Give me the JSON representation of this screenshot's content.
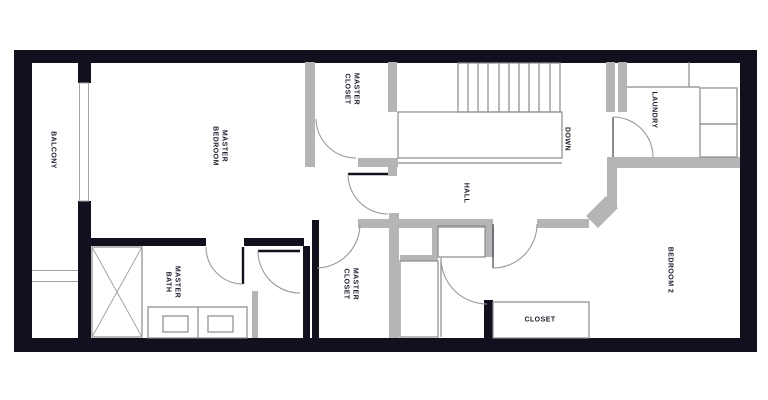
{
  "title": "Second floor plan",
  "colors": {
    "wall_black": "#10101e",
    "wall_gray": "#b5b5b5",
    "thin_line": "#8a8a8a",
    "label_ink": "#1c1c2e",
    "background": "#ffffff"
  },
  "rooms": {
    "balcony": {
      "label": "BALCONY"
    },
    "master_bedroom": {
      "label": "MASTER BEDROOM",
      "line1": "MASTER",
      "line2": "BEDROOM"
    },
    "master_closet_upper": {
      "label": "MASTER CLOSET",
      "line1": "MASTER",
      "line2": "CLOSET"
    },
    "master_bath": {
      "label": "MASTER BATH",
      "line1": "MASTER",
      "line2": "BATH"
    },
    "master_closet_lower": {
      "label": "MASTER CLOSET",
      "line1": "MASTER",
      "line2": "CLOSET"
    },
    "hall": {
      "label": "HALL"
    },
    "stairs": {
      "label": "DOWN"
    },
    "laundry": {
      "label": "LAUNDRY"
    },
    "bedroom2": {
      "label": "BEDROOM 2"
    },
    "closet": {
      "label": "CLOSET"
    }
  }
}
